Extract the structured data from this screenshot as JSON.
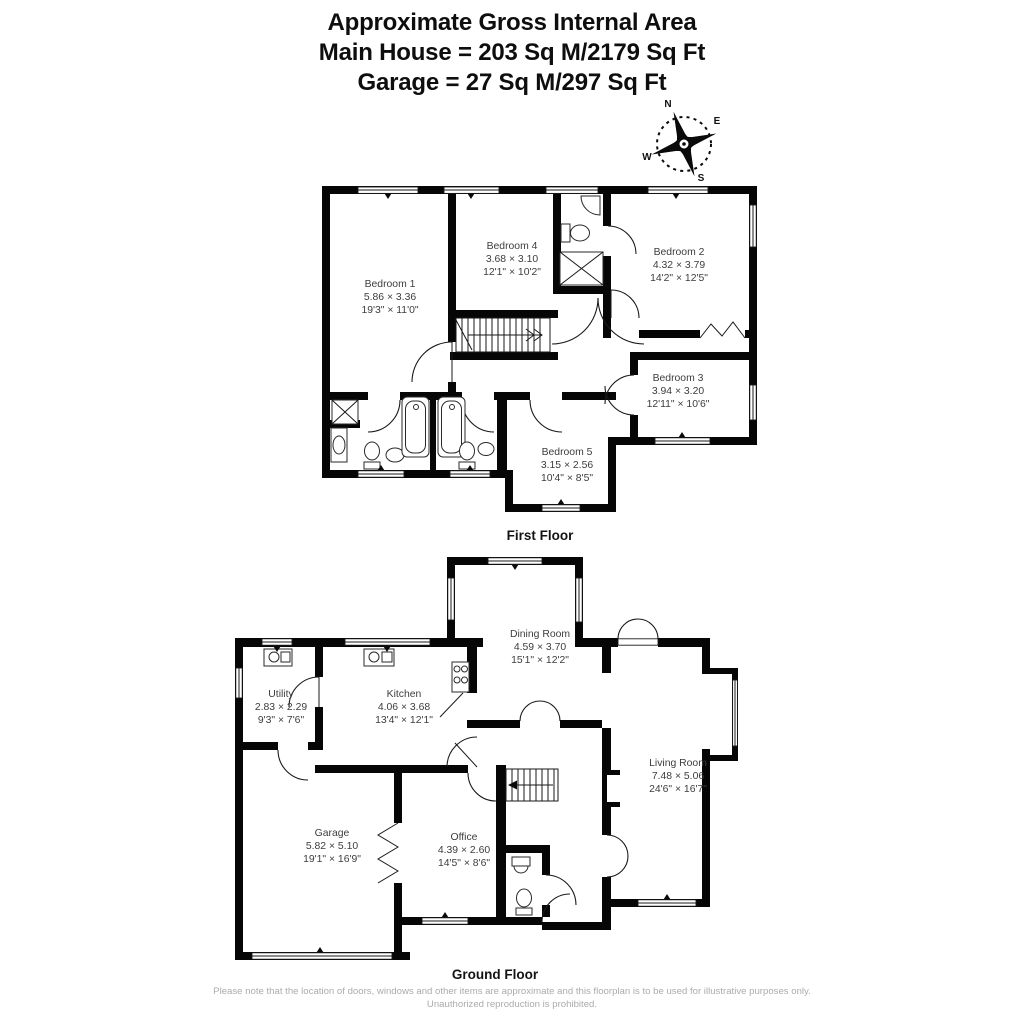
{
  "header": {
    "line1": "Approximate Gross Internal Area",
    "line2": "Main House = 203 Sq M/2179 Sq Ft",
    "line3": "Garage = 27 Sq M/297 Sq Ft"
  },
  "compass": {
    "north": "N",
    "east": "E",
    "south": "S",
    "west": "W"
  },
  "first_floor": {
    "label": "First Floor",
    "rooms": {
      "bedroom1": {
        "name": "Bedroom 1",
        "metric": "5.86 × 3.36",
        "imperial": "19'3\" × 11'0\""
      },
      "bedroom4": {
        "name": "Bedroom 4",
        "metric": "3.68 × 3.10",
        "imperial": "12'1\" × 10'2\""
      },
      "bedroom2": {
        "name": "Bedroom 2",
        "metric": "4.32 × 3.79",
        "imperial": "14'2\" × 12'5\""
      },
      "bedroom3": {
        "name": "Bedroom 3",
        "metric": "3.94 × 3.20",
        "imperial": "12'11\" × 10'6\""
      },
      "bedroom5": {
        "name": "Bedroom 5",
        "metric": "3.15 × 2.56",
        "imperial": "10'4\" × 8'5\""
      }
    }
  },
  "ground_floor": {
    "label": "Ground Floor",
    "rooms": {
      "dining": {
        "name": "Dining Room",
        "metric": "4.59 × 3.70",
        "imperial": "15'1\" × 12'2\""
      },
      "utility": {
        "name": "Utility",
        "metric": "2.83 × 2.29",
        "imperial": "9'3\" × 7'6\""
      },
      "kitchen": {
        "name": "Kitchen",
        "metric": "4.06 × 3.68",
        "imperial": "13'4\" × 12'1\""
      },
      "living": {
        "name": "Living Room",
        "metric": "7.48 × 5.06",
        "imperial": "24'6\" × 16'7\""
      },
      "garage": {
        "name": "Garage",
        "metric": "5.82 × 5.10",
        "imperial": "19'1\" × 16'9\""
      },
      "office": {
        "name": "Office",
        "metric": "4.39 × 2.60",
        "imperial": "14'5\" × 8'6\""
      }
    }
  },
  "footer": {
    "disclaimer": "Please note that the location of doors, windows and other items are approximate and this floorplan is to be used for illustrative purposes only. Unauthorized reproduction is prohibited."
  },
  "colors": {
    "wall": "#000000",
    "label_text": "#3d3d3d",
    "footer_text": "#ababab",
    "background": "#ffffff"
  }
}
